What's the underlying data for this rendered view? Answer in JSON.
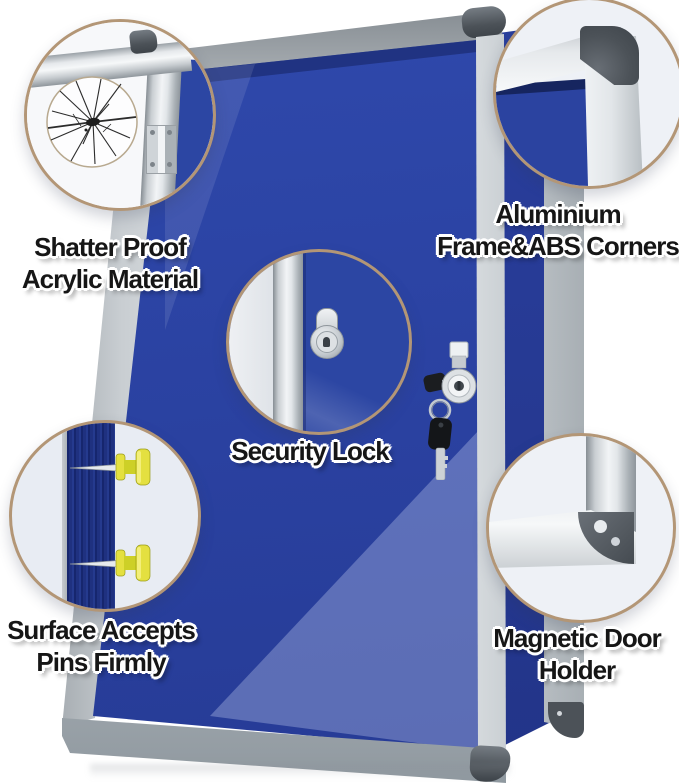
{
  "image_type": "notice-board product feature infographic",
  "callouts": {
    "shatterproof": {
      "line1": "Shatter Proof",
      "line2": "Acrylic Material"
    },
    "frame_corners": {
      "line1": "Aluminium",
      "line2": "Frame&ABS Corners"
    },
    "security_lock": {
      "line1": "Security Lock"
    },
    "pins": {
      "line1": "Surface Accepts",
      "line2": "Pins Firmly"
    },
    "magnetic_holder": {
      "line1": "Magnetic Door",
      "line2": "Holder"
    }
  },
  "colors": {
    "background": "#ffffff",
    "board_felt_blue": "#2c46a3",
    "frame_silver": "#d9dde0",
    "abs_corner_gray": "#4c5258",
    "callout_ring_tan": "#b39676",
    "pushpin_yellow": "#e4e040",
    "felt_cross_section_navy": "#1d2d7d"
  }
}
